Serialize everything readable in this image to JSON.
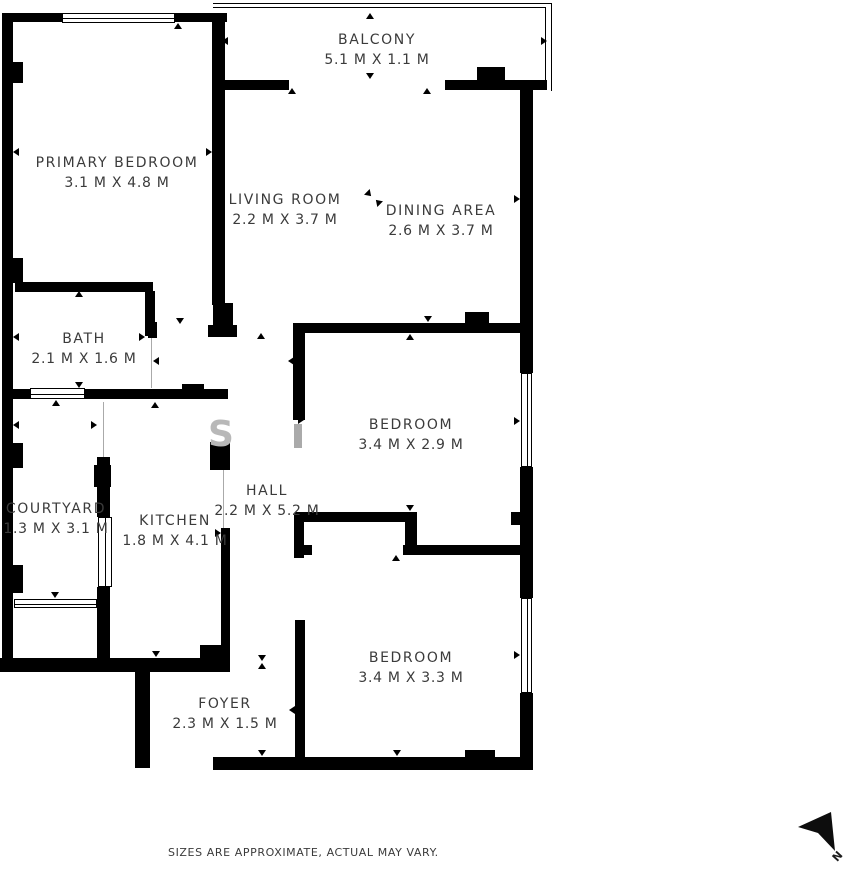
{
  "plan": {
    "rooms": [
      {
        "id": "balcony",
        "name": "BALCONY",
        "dims": "5.1 M X 1.1 M"
      },
      {
        "id": "primary-bedroom",
        "name": "PRIMARY BEDROOM",
        "dims": "3.1 M X 4.8 M"
      },
      {
        "id": "living-room",
        "name": "LIVING ROOM",
        "dims": "2.2 M X 3.7 M"
      },
      {
        "id": "dining-area",
        "name": "DINING AREA",
        "dims": "2.6 M X 3.7 M"
      },
      {
        "id": "bath",
        "name": "BATH",
        "dims": "2.1 M X 1.6 M"
      },
      {
        "id": "bedroom-1",
        "name": "BEDROOM",
        "dims": "3.4 M X 2.9 M"
      },
      {
        "id": "courtyard",
        "name": "COURTYARD",
        "dims": "1.3 M X 3.1 M"
      },
      {
        "id": "kitchen",
        "name": "KITCHEN",
        "dims": "1.8 M X 4.1 M"
      },
      {
        "id": "hall",
        "name": "HALL",
        "dims": "2.2 M X 5.2 M"
      },
      {
        "id": "bedroom-2",
        "name": "BEDROOM",
        "dims": "3.4 M X 3.3 M"
      },
      {
        "id": "foyer",
        "name": "FOYER",
        "dims": "2.3 M X 1.5 M"
      }
    ],
    "disclaimer": "SIZES ARE APPROXIMATE, ACTUAL MAY VARY.",
    "compass": {
      "label": "N"
    },
    "watermark": "S",
    "colors": {
      "wall": "#000000",
      "text": "#3b3b3b",
      "watermark": "#b8b8b8",
      "door_gray": "#aaaaaa"
    }
  }
}
